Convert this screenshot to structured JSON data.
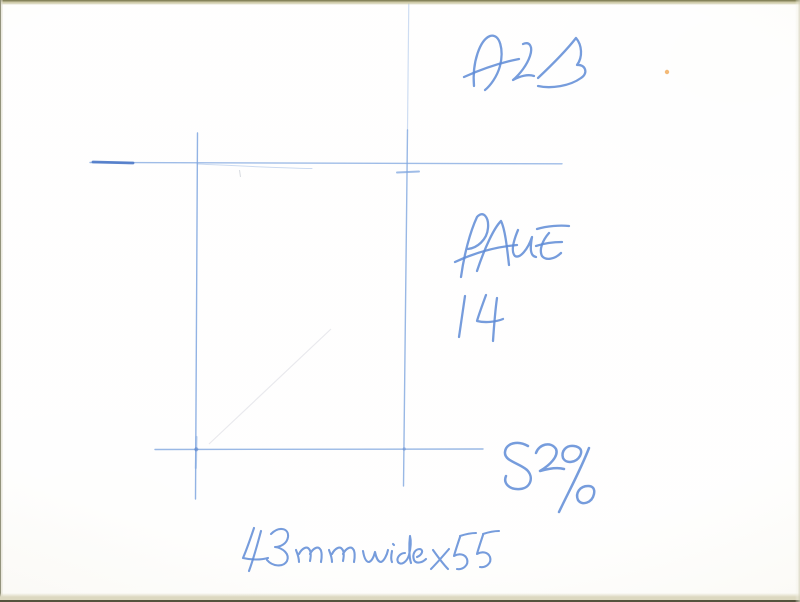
{
  "document": {
    "kind": "scanned photo crop-mark sheet with handwritten sizing notes",
    "paper_color": "#fbfaf5",
    "ink_color": "#5e8bd6",
    "line_color": "#7fa6df",
    "line_dark_color": "#4c79c8",
    "speck_color": "#f0a855"
  },
  "annotations": {
    "top_right_scribble": "ARTS",
    "page_word": "PAGE",
    "page_number": "14",
    "scale": "82%",
    "size_note": "43mm wide x 55"
  }
}
